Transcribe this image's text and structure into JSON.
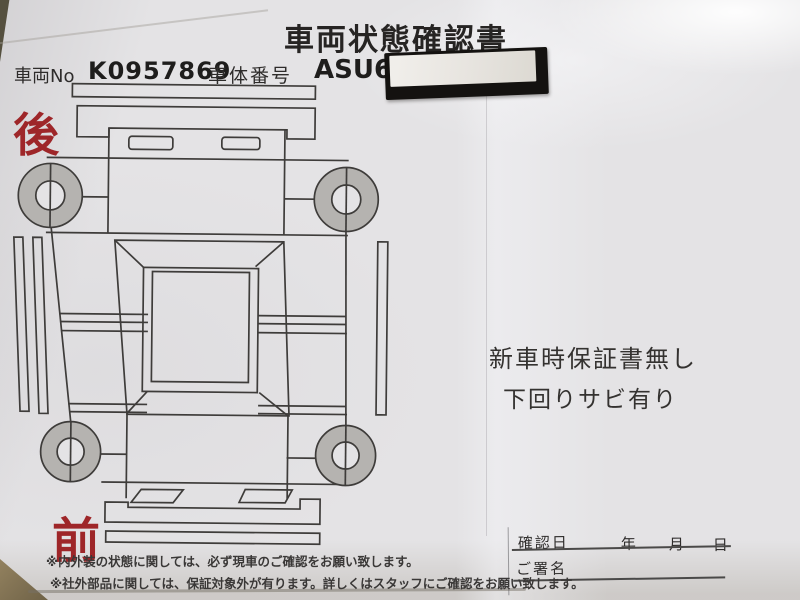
{
  "document": {
    "title": "車両状態確認書",
    "header": {
      "vehicle_no_label": "車両No",
      "vehicle_no_value": "K0957869",
      "body_no_label": "車体番号",
      "body_no_value": "ASU65"
    },
    "diagram": {
      "rear_label": "後",
      "front_label": "前"
    },
    "condition_notes": [
      "新車時保証書無し",
      "下回りサビ有り"
    ],
    "signature": {
      "date_label": "確認日",
      "year_label": "年",
      "month_label": "月",
      "day_label": "日",
      "sign_label": "ご署名"
    },
    "footnotes": [
      "※内外装の状態に関しては、必ず現車のご確認をお願い致します。",
      "※社外部品に関しては、保証対象外が有ります。詳しくはスタッフにご確認をお願い致します。"
    ]
  },
  "colors": {
    "accent_red": "#9e2629",
    "paper": "#e4e3e5",
    "diagram_line": "#3e3c3a",
    "wheel_gray": "#b5b3b0",
    "tape_black": "#141210",
    "tape_label_white": "#efede9",
    "table_tan": "#8f7d5c"
  }
}
